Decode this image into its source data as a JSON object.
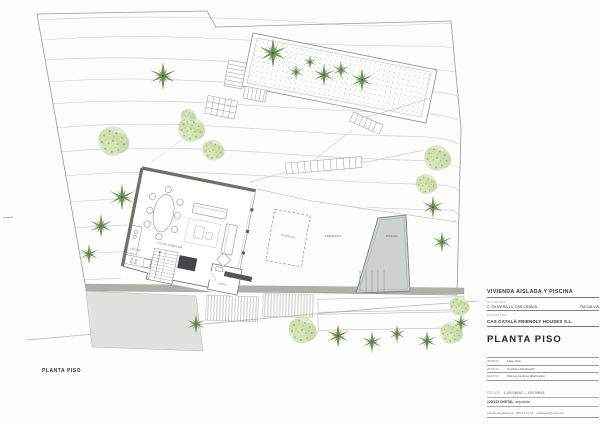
{
  "plan": {
    "caption": "PLANTA PISO",
    "labels": {
      "estar_comedor": "ESTAR COMEDOR",
      "cocina": "COCINA",
      "aseo": "ASEO",
      "pergola": "PERGOLA",
      "terraza": "TERRAZA",
      "piscina": "PISCINA"
    }
  },
  "titleblock": {
    "project": "VIVIENDA AISLADA Y PISCINA",
    "situacion_label": "SITUACION",
    "address": "C. OLIVERA 14, CAS CATALÀ",
    "municipality": "TM CALVIA",
    "promotor_label": "PROMOTOR",
    "client": "CAS CATALÀ FRIENDLY HOUSES S.L.",
    "sheet_title": "PLANTA PISO",
    "revisions": [
      {
        "date": "05/05/23",
        "note": "Fase obra"
      },
      {
        "date": "20/06/23",
        "note": "Cambios distribución"
      },
      {
        "date": "01/07/23",
        "note": "Últimos cambios distribución"
      }
    ],
    "scale_label": "ESCALA",
    "scale_value": "1:100 DIN A3  —  1:50 DIN A1",
    "author": "120/122 DIGITAL",
    "author_role": ", arquitecto",
    "contact": "estudio arquitectura · 659.11.70.73 · mailarea@gmail.com"
  }
}
